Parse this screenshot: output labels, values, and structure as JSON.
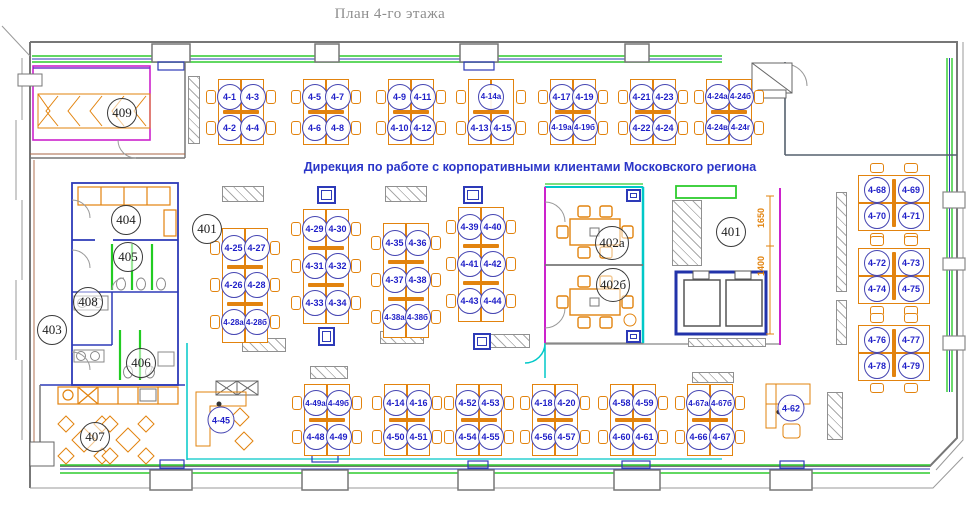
{
  "header": {
    "title": "План 4-го этажа"
  },
  "plan": {
    "subtitle": "Дирекция по работе с корпоративными клиентами Московского региона",
    "rooms": [
      {
        "number": "409",
        "x": 122,
        "y": 113
      },
      {
        "number": "404",
        "x": 126,
        "y": 220
      },
      {
        "number": "405",
        "x": 128,
        "y": 257
      },
      {
        "number": "408",
        "x": 88,
        "y": 302
      },
      {
        "number": "403",
        "x": 52,
        "y": 330
      },
      {
        "number": "406",
        "x": 141,
        "y": 363
      },
      {
        "number": "407",
        "x": 95,
        "y": 437
      },
      {
        "number": "401",
        "x": 207,
        "y": 229
      },
      {
        "number": "402а",
        "x": 612,
        "y": 243
      },
      {
        "number": "402б",
        "x": 613,
        "y": 285
      },
      {
        "number": "401",
        "x": 731,
        "y": 232
      }
    ],
    "dimensions": [
      {
        "text": "1650",
        "x": 761,
        "y": 218
      },
      {
        "text": "1400",
        "x": 761,
        "y": 266
      }
    ],
    "clusters": [
      {
        "x": 241,
        "y": 112,
        "pitch": 31,
        "rows": [
          [
            "4-1",
            "4-3"
          ],
          [
            "4-2",
            "4-4"
          ]
        ]
      },
      {
        "x": 326,
        "y": 112,
        "pitch": 31,
        "rows": [
          [
            "4-5",
            "4-7"
          ],
          [
            "4-6",
            "4-8"
          ]
        ]
      },
      {
        "x": 411,
        "y": 112,
        "pitch": 31,
        "rows": [
          [
            "4-9",
            "4-11"
          ],
          [
            "4-10",
            "4-12"
          ]
        ]
      },
      {
        "x": 491,
        "y": 112,
        "pitch": 31,
        "rows": [
          [
            "4-14а"
          ],
          [
            "4-13",
            "4-15"
          ]
        ]
      },
      {
        "x": 573,
        "y": 112,
        "pitch": 31,
        "rows": [
          [
            "4-17",
            "4-19"
          ],
          [
            "4-19а",
            "4-19б"
          ]
        ]
      },
      {
        "x": 653,
        "y": 112,
        "pitch": 31,
        "rows": [
          [
            "4-21",
            "4-23"
          ],
          [
            "4-22",
            "4-24"
          ]
        ]
      },
      {
        "x": 729,
        "y": 112,
        "pitch": 31,
        "rows": [
          [
            "4-24а",
            "4-24б"
          ],
          [
            "4-24в",
            "4-24г"
          ]
        ]
      },
      {
        "x": 245,
        "y": 285,
        "pitch": 37,
        "rows": [
          [
            "4-25",
            "4-27"
          ],
          [
            "4-26",
            "4-28"
          ],
          [
            "4-28а",
            "4-28б"
          ]
        ]
      },
      {
        "x": 326,
        "y": 266,
        "pitch": 37,
        "rows": [
          [
            "4-29",
            "4-30"
          ],
          [
            "4-31",
            "4-32"
          ],
          [
            "4-33",
            "4-34"
          ]
        ]
      },
      {
        "x": 406,
        "y": 280,
        "pitch": 37,
        "rows": [
          [
            "4-35",
            "4-36"
          ],
          [
            "4-37",
            "4-38"
          ],
          [
            "4-38а",
            "4-38б"
          ]
        ]
      },
      {
        "x": 481,
        "y": 264,
        "pitch": 37,
        "rows": [
          [
            "4-39",
            "4-40"
          ],
          [
            "4-41",
            "4-42"
          ],
          [
            "4-43",
            "4-44"
          ]
        ]
      },
      {
        "x": 327,
        "y": 420,
        "pitch": 34,
        "rows": [
          [
            "4-49а",
            "4-49б"
          ],
          [
            "4-48",
            "4-49"
          ]
        ]
      },
      {
        "x": 407,
        "y": 420,
        "pitch": 34,
        "rows": [
          [
            "4-14",
            "4-16"
          ],
          [
            "4-50",
            "4-51"
          ]
        ]
      },
      {
        "x": 479,
        "y": 420,
        "pitch": 34,
        "rows": [
          [
            "4-52",
            "4-53"
          ],
          [
            "4-54",
            "4-55"
          ]
        ]
      },
      {
        "x": 555,
        "y": 420,
        "pitch": 34,
        "rows": [
          [
            "4-18",
            "4-20"
          ],
          [
            "4-56",
            "4-57"
          ]
        ]
      },
      {
        "x": 633,
        "y": 420,
        "pitch": 34,
        "rows": [
          [
            "4-58",
            "4-59"
          ],
          [
            "4-60",
            "4-61"
          ]
        ]
      },
      {
        "x": 710,
        "y": 420,
        "pitch": 34,
        "rows": [
          [
            "4-67а",
            "4-67б"
          ],
          [
            "4-66",
            "4-67"
          ]
        ]
      },
      {
        "x": 894,
        "y": 203,
        "dir": "h",
        "pitch": 26,
        "dx": 17,
        "rows": [
          [
            "4-68",
            "4-69"
          ],
          [
            "4-70",
            "4-71"
          ]
        ]
      },
      {
        "x": 894,
        "y": 276,
        "dir": "h",
        "pitch": 26,
        "dx": 17,
        "rows": [
          [
            "4-72",
            "4-73"
          ],
          [
            "4-74",
            "4-75"
          ]
        ]
      },
      {
        "x": 894,
        "y": 353,
        "dir": "h",
        "pitch": 26,
        "dx": 17,
        "rows": [
          [
            "4-76",
            "4-77"
          ],
          [
            "4-78",
            "4-79"
          ]
        ]
      }
    ],
    "workstations": [
      {
        "label": "4-45",
        "x": 221,
        "y": 420
      },
      {
        "label": "4-62",
        "x": 791,
        "y": 408
      }
    ],
    "racks": [
      {
        "x": 188,
        "y": 76,
        "w": 12,
        "h": 68
      },
      {
        "x": 222,
        "y": 186,
        "w": 42,
        "h": 16
      },
      {
        "x": 385,
        "y": 186,
        "w": 42,
        "h": 16
      },
      {
        "x": 242,
        "y": 338,
        "w": 44,
        "h": 14
      },
      {
        "x": 380,
        "y": 331,
        "w": 44,
        "h": 13
      },
      {
        "x": 490,
        "y": 334,
        "w": 40,
        "h": 14
      },
      {
        "x": 310,
        "y": 366,
        "w": 38,
        "h": 13
      },
      {
        "x": 672,
        "y": 200,
        "w": 30,
        "h": 66
      },
      {
        "x": 688,
        "y": 338,
        "w": 78,
        "h": 9
      },
      {
        "x": 692,
        "y": 372,
        "w": 42,
        "h": 11
      },
      {
        "x": 836,
        "y": 192,
        "w": 11,
        "h": 100
      },
      {
        "x": 836,
        "y": 300,
        "w": 11,
        "h": 45
      },
      {
        "x": 827,
        "y": 392,
        "w": 16,
        "h": 48
      }
    ],
    "columns": [
      {
        "x": 317,
        "y": 186,
        "w": 19,
        "h": 18
      },
      {
        "x": 463,
        "y": 186,
        "w": 20,
        "h": 18
      },
      {
        "x": 318,
        "y": 327,
        "w": 17,
        "h": 19
      },
      {
        "x": 473,
        "y": 333,
        "w": 18,
        "h": 17
      },
      {
        "x": 626,
        "y": 189,
        "w": 15,
        "h": 13
      },
      {
        "x": 626,
        "y": 330,
        "w": 15,
        "h": 13
      }
    ]
  }
}
